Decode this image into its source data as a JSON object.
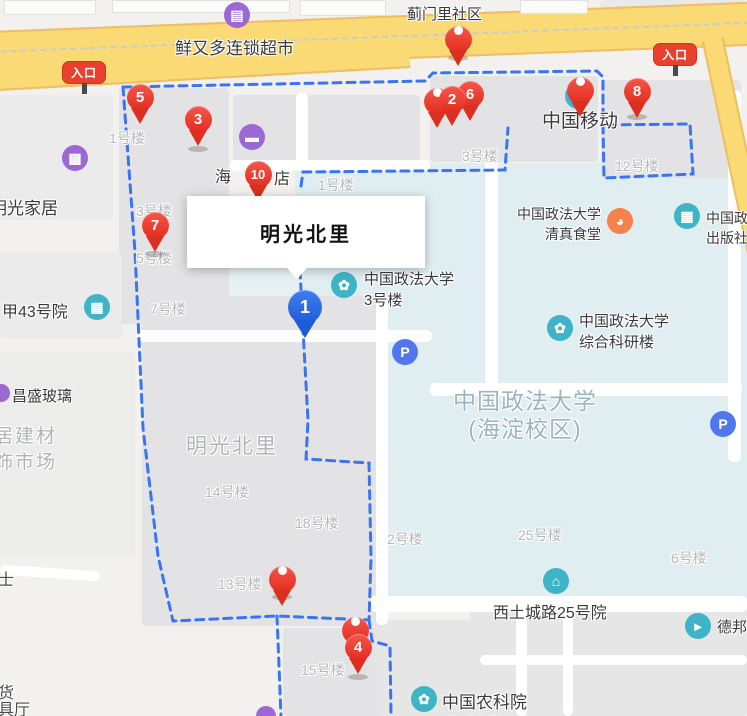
{
  "infobox": {
    "title": "明光北里"
  },
  "road_labels": {
    "jimenli": "蓟门里社区",
    "supermarket": "鲜又多连锁超市"
  },
  "entrance_label": "入口",
  "pins": {
    "p1": "1",
    "p2": "2",
    "p3": "3",
    "p4": "4",
    "p5": "5",
    "p6": "6",
    "p7": "7",
    "p8": "8",
    "p10": "10"
  },
  "poi": {
    "mobile": "中国移动",
    "uni_b3_l1": "中国政法大学",
    "uni_b3_l2": "3号楼",
    "canteen_l1": "中国政法大学",
    "canteen_l2": "清真食堂",
    "press_l1": "中国政法大学",
    "press_l2": "出版社",
    "keyan_l1": "中国政法大学",
    "keyan_l2": "综合科研楼",
    "xitucheng": "西土城路25号院",
    "nongkeyuan_l1": "中国农科院",
    "nongkeyuan_l2": "附属小学分校",
    "debang": "德邦物流",
    "changsheng": "昌盛玻璃",
    "home": "明光家居",
    "jia43": "甲43号院",
    "hotel_left": "海",
    "hotel_right": "店",
    "frag_shi": "士",
    "frag_huo": "货",
    "frag_juting": "具厅"
  },
  "buildings": {
    "b1a": "1号楼",
    "b3a": "3号楼",
    "b5": "5号楼",
    "b7": "7号楼",
    "b1b": "1号楼",
    "b3b": "3号楼",
    "b12": "12号楼",
    "b14": "14号楼",
    "b18": "18号楼",
    "b2": "2号楼",
    "b25": "25号楼",
    "b6": "6号楼",
    "b13": "13号楼",
    "b15": "15号楼"
  },
  "areas": {
    "mingguang": "明光北里",
    "campus_l1": "中国政法大学",
    "campus_l2": "(海淀校区)"
  },
  "colors": {
    "road_yellow": "#f9da74",
    "boundary_blue": "#3a74f2",
    "pin_red": "#ee3c2e",
    "pin_blue": "#2e6ee6",
    "poi_teal": "#3eb4c6",
    "poi_purple": "#9c68d4",
    "poi_orange": "#f5814c",
    "parking_blue": "#5077ee",
    "campus_fill": "#e0eef2"
  }
}
